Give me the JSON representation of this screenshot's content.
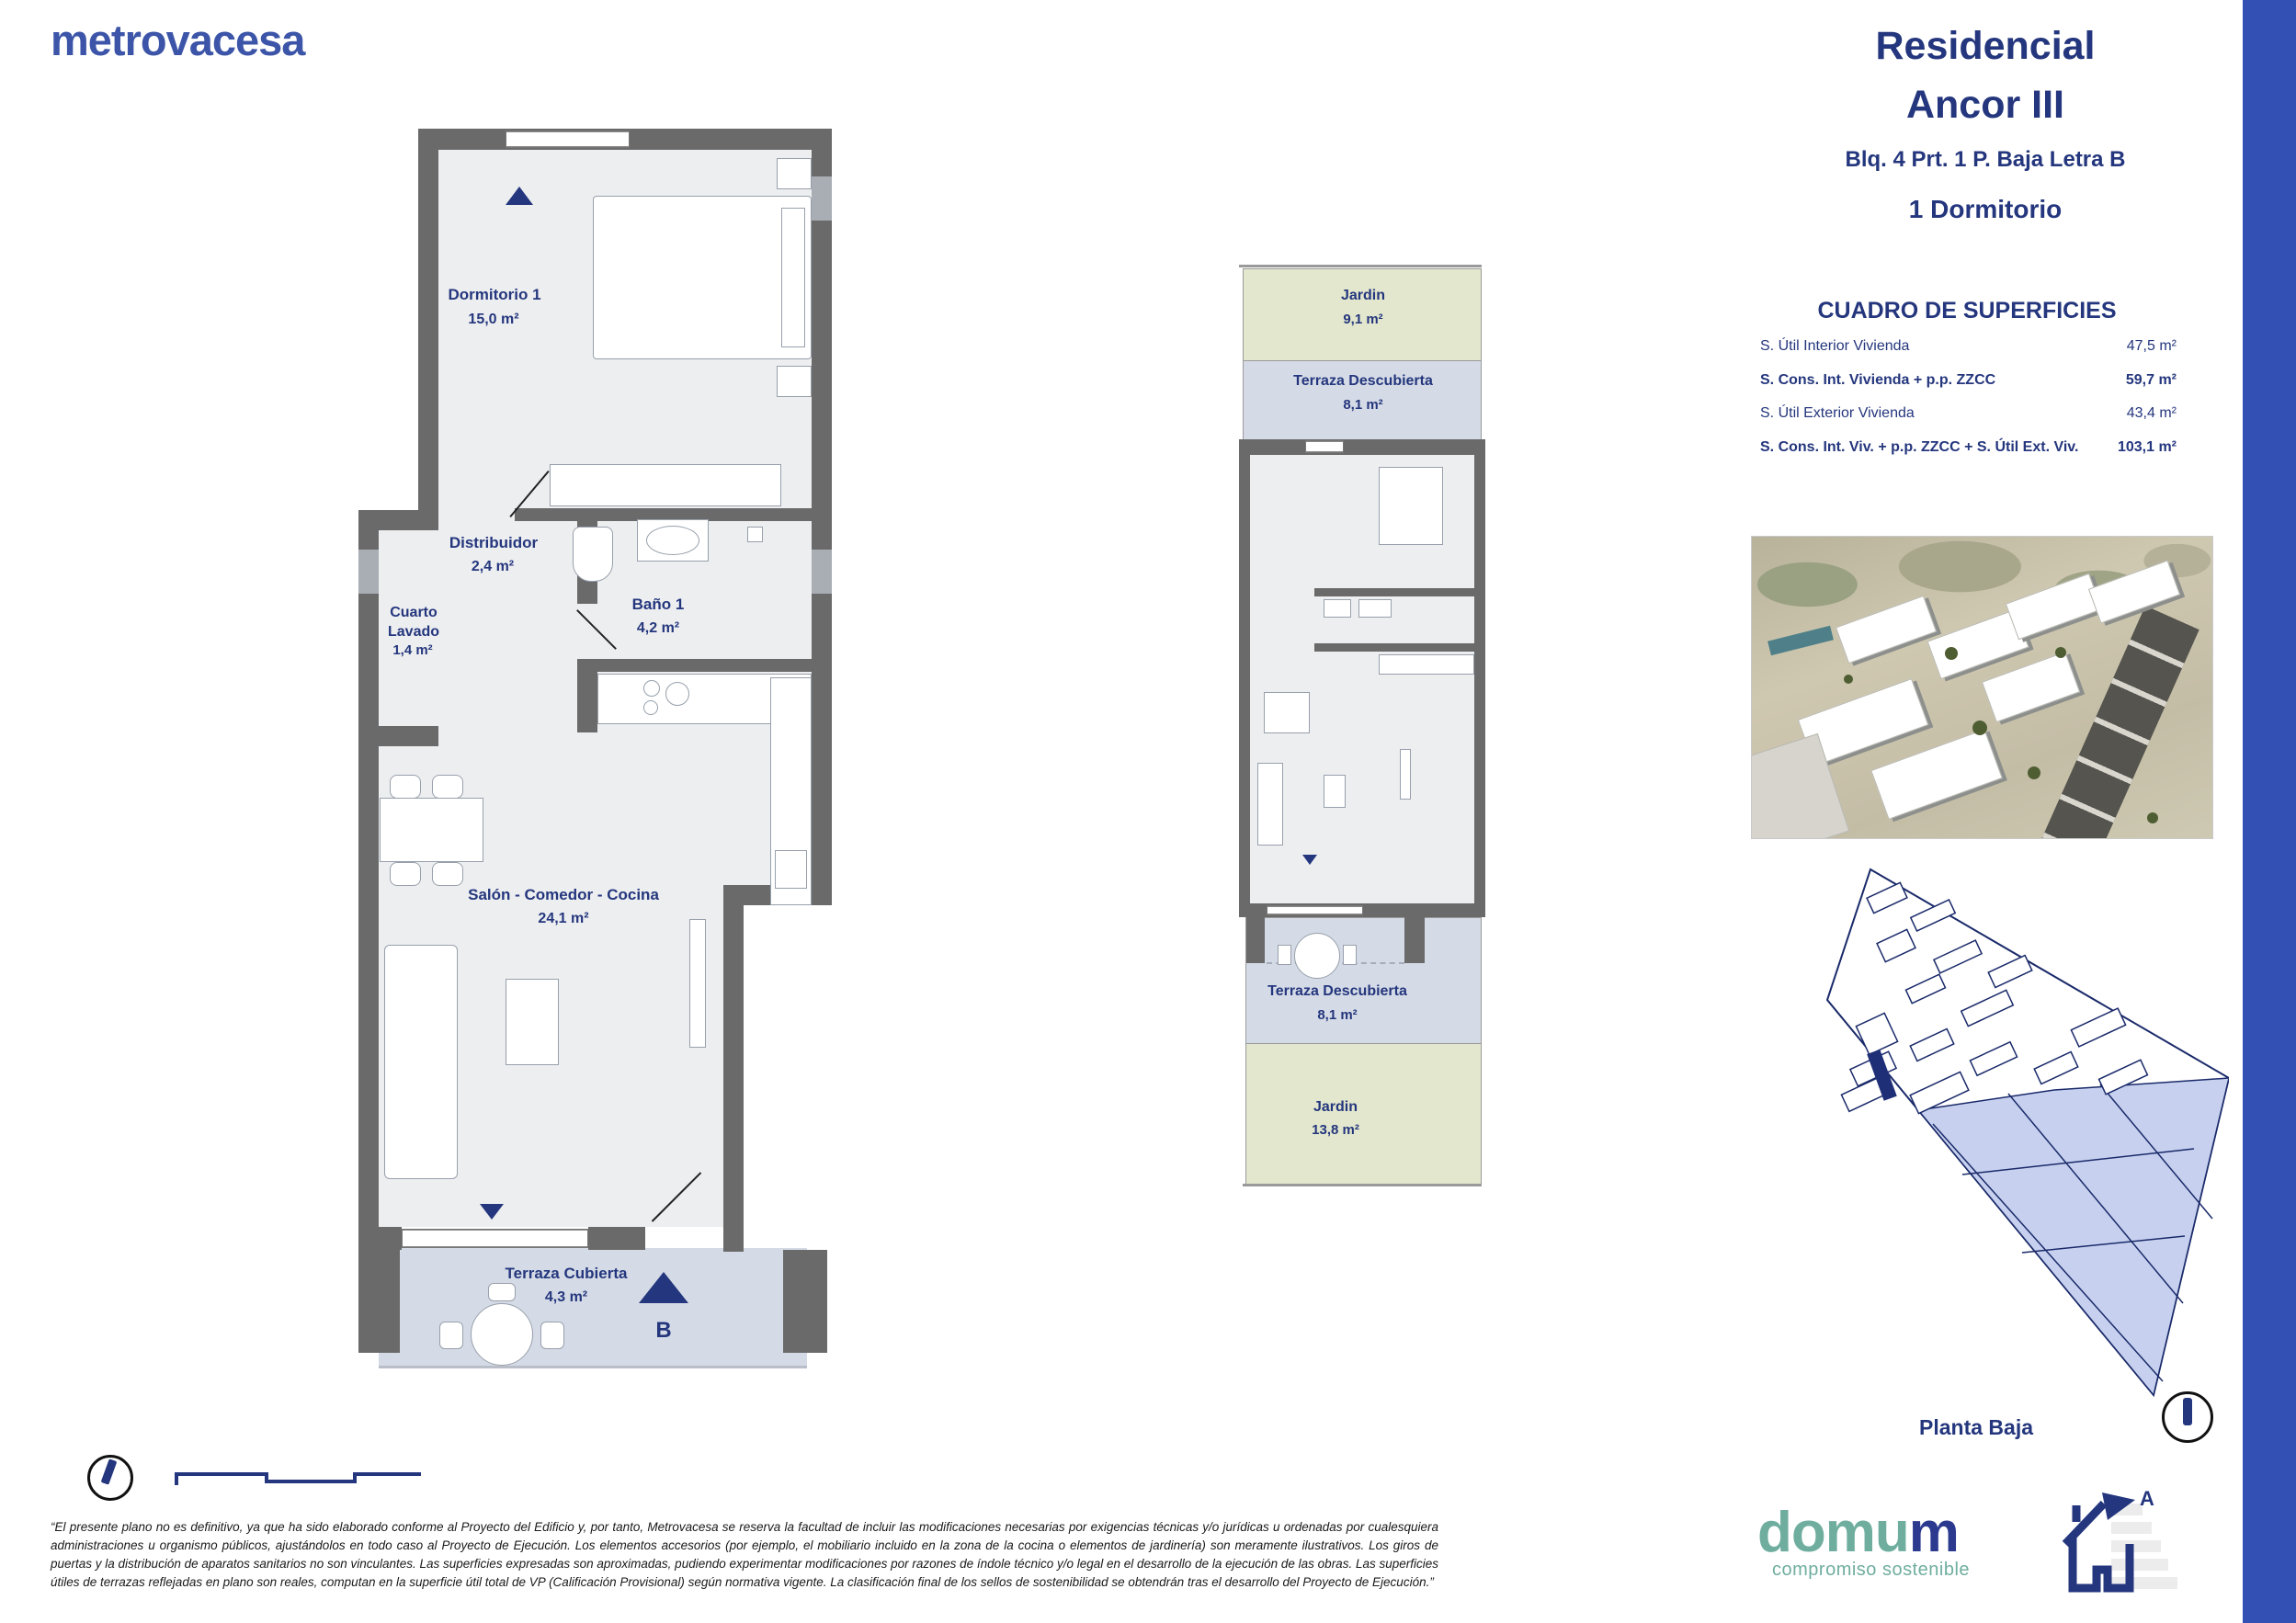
{
  "brand": {
    "logo_text": "metrovacesa"
  },
  "header": {
    "title_line1": "Residencial",
    "title_line2": "Ancor III",
    "unit": "Blq. 4 Prt. 1 P. Baja Letra B",
    "type": "1 Dormitorio"
  },
  "surfaces": {
    "title": "CUADRO DE SUPERFICIES",
    "rows": [
      {
        "label": "S. Útil Interior Vivienda",
        "value": "47,5 m²"
      },
      {
        "label": "S. Cons. Int. Vivienda + p.p. ZZCC",
        "value": "59,7 m²"
      },
      {
        "label": "S. Útil Exterior Vivienda",
        "value": "43,4 m²"
      },
      {
        "label": "S. Cons. Int. Viv. + p.p. ZZCC + S. Útil Ext. Viv.",
        "value": "103,1 m²"
      }
    ]
  },
  "main_plan": {
    "rooms": {
      "dormitorio": {
        "name": "Dormitorio 1",
        "area": "15,0 m²"
      },
      "distribuidor": {
        "name": "Distribuidor",
        "area": "2,4 m²"
      },
      "cuarto_lavado": {
        "name_line1": "Cuarto",
        "name_line2": "Lavado",
        "area": "1,4 m²"
      },
      "bano": {
        "name": "Baño 1",
        "area": "4,2 m²"
      },
      "salon": {
        "name": "Salón - Comedor - Cocina",
        "area": "24,1 m²"
      },
      "terraza_cubierta": {
        "name": "Terraza Cubierta",
        "area": "4,3 m²"
      }
    },
    "unit_letter": "B"
  },
  "small_plan": {
    "jardin_top": {
      "name": "Jardin",
      "area": "9,1 m²"
    },
    "terraza_top": {
      "name": "Terraza Descubierta",
      "area": "8,1 m²"
    },
    "terraza_bottom": {
      "name": "Terraza Descubierta",
      "area": "8,1 m²"
    },
    "jardin_bottom": {
      "name": "Jardin",
      "area": "13,8 m²"
    }
  },
  "site_plan": {
    "caption": "Planta Baja"
  },
  "footer": {
    "disclaimer": "“El presente plano no es definitivo, ya que ha sido elaborado conforme al Proyecto del Edificio y, por tanto, Metrovacesa se reserva la facultad de incluir las modificaciones necesarias por exigencias técnicas y/o jurídicas u ordenadas por cualesquiera administraciones u organismo públicos, ajustándolos en todo caso al Proyecto de Ejecución. Los elementos accesorios (por ejemplo, el mobiliario incluido en la zona de la cocina o elementos de jardinería) son meramente ilustrativos. Los giros de puertas y la distribución de aparatos sanitarios no son vinculantes. Las superficies expresadas son aproximadas, pudiendo experimentar modificaciones por razones de índole técnico y/o legal en el desarrollo de la ejecución de las obras. Las superficies útiles de terrazas reflejadas en plano son reales, computan en la superficie útil total de VP (Calificación Provisional) según normativa vigente. La clasificación final de los sellos de sostenibilidad se obtendrán tras el desarrollo del Proyecto de Ejecución.”",
    "domum_part1": "domu",
    "domum_part2": "m",
    "domum_tagline": "compromiso sostenible",
    "energy_letter": "A"
  },
  "colors": {
    "navy": "#24367d",
    "brand_blue": "#3c55a8",
    "accent_bar": "#3350b5",
    "wall_gray": "#6a6a6a",
    "interior_fill": "#edeef0",
    "terrace_fill": "#d5dbe6",
    "garden_fill": "#e2e7cd",
    "siteplan_blue": "#c7d1ef",
    "domum_teal": "#6fae9f"
  }
}
